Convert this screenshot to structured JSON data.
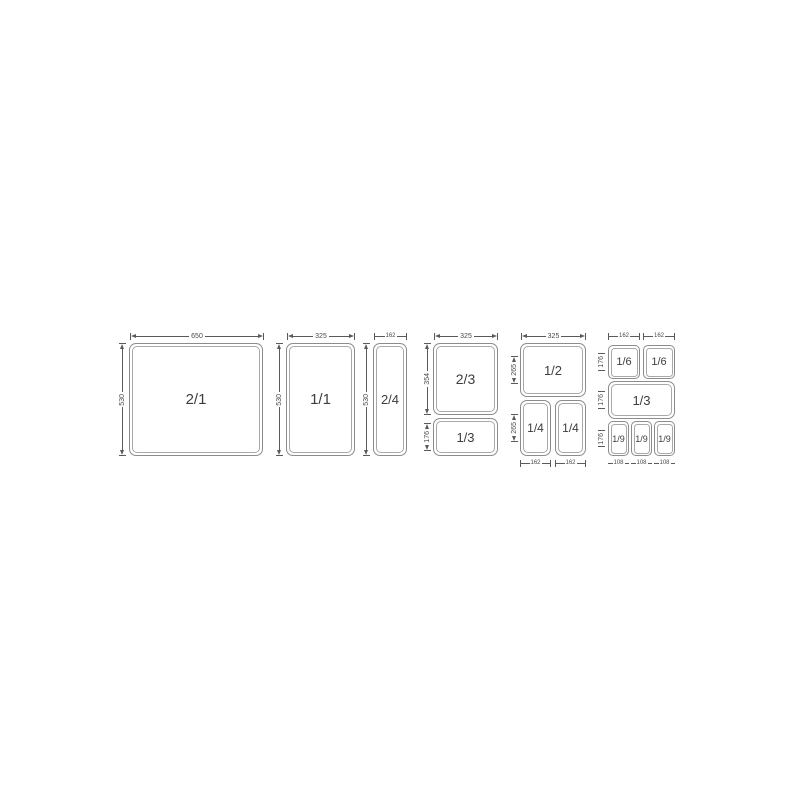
{
  "colors": {
    "background": "#ffffff",
    "line": "#5a5a5a",
    "pan_border": "#8c8c8c",
    "pan_inner": "#a8a8a8",
    "label": "#3d3d3d",
    "dim_text": "#4a4a4a"
  },
  "diagram": {
    "type": "gastronorm-pan-size-diagram",
    "groups": [
      {
        "top_dims": [
          "650"
        ],
        "left_dims": [
          "530"
        ],
        "bottom_dims": [],
        "pans": [
          "2/1"
        ]
      },
      {
        "top_dims": [
          "325"
        ],
        "left_dims": [
          "530"
        ],
        "bottom_dims": [],
        "pans": [
          "1/1"
        ]
      },
      {
        "top_dims": [
          "162"
        ],
        "left_dims": [
          "530"
        ],
        "bottom_dims": [],
        "pans": [
          "2/4"
        ]
      },
      {
        "top_dims": [
          "325"
        ],
        "left_dims": [
          "354",
          "176"
        ],
        "bottom_dims": [],
        "pans": [
          "2/3",
          "1/3"
        ]
      },
      {
        "top_dims": [
          "325"
        ],
        "left_dims": [
          "265",
          "265"
        ],
        "bottom_dims": [
          "162",
          "162"
        ],
        "pans": [
          "1/2",
          "1/4",
          "1/4"
        ]
      },
      {
        "top_dims": [
          "162",
          "162"
        ],
        "left_dims": [
          "176",
          "176",
          "176"
        ],
        "bottom_dims": [
          "108",
          "108",
          "108"
        ],
        "pans": [
          "1/6",
          "1/6",
          "1/3",
          "1/9",
          "1/9",
          "1/9"
        ]
      }
    ]
  }
}
